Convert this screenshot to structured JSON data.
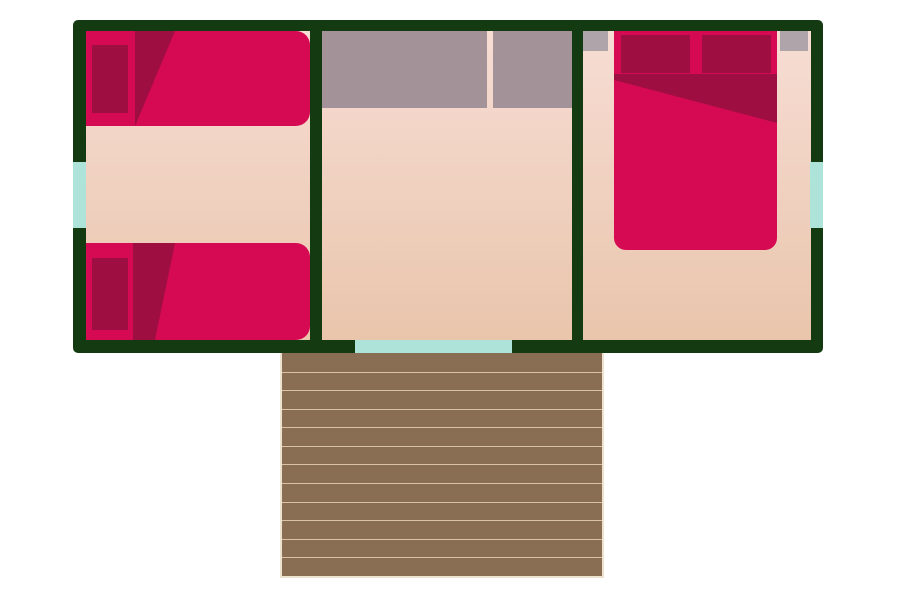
{
  "title": "cabin-floor-plan",
  "colors": {
    "background": "#ffffff",
    "wall": "#143a12",
    "floor_top": "#f7ddd4",
    "floor_bottom": "#e9c5ac",
    "bed": "#d60a52",
    "bed_dark": "#9e0e41",
    "counter": "#a39399",
    "shelf": "#aea4a9",
    "glass": "#aee3da",
    "deck": "#8a6e53",
    "deck_line": "#d8c3a6",
    "deck_border": "#eee3d0"
  },
  "plan": {
    "rooms": [
      {
        "name": "twin-bedroom",
        "furniture": [
          "single-bed",
          "single-bed"
        ]
      },
      {
        "name": "living-area",
        "furniture": [
          "counter-left-section",
          "counter-right-section"
        ]
      },
      {
        "name": "double-bedroom",
        "furniture": [
          "double-bed",
          "shelf",
          "shelf"
        ]
      }
    ],
    "openings": [
      "window-left",
      "window-right",
      "front-door",
      "doorway-left-dashed",
      "doorway-right-dashed"
    ],
    "deck": {
      "planks": 12
    }
  }
}
